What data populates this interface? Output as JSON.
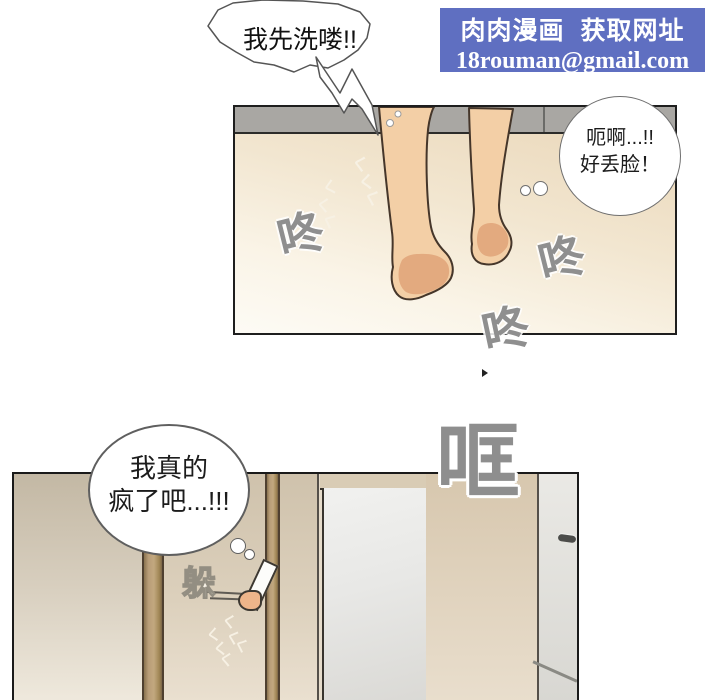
{
  "banner": {
    "title": "肉肉漫画  获取网址",
    "email": "18rouman@gmail.com",
    "bg_color": "#5f6fc1"
  },
  "panel1": {
    "speech": "我先洗喽!!",
    "thought_line1": "呃啊...!!",
    "thought_line2": "好丢脸！"
  },
  "panel2": {
    "thought_line1": "我真的",
    "thought_line2": "疯了吧...!!!",
    "sfx_clang": "哐",
    "sfx_hide": "躲"
  },
  "sfx": {
    "thud": "咚",
    "steam": "く"
  },
  "colors": {
    "skin": "#f3cfa6",
    "sfx_gray": "#8f8f8f",
    "wood_post": "#b2966e",
    "floor_top": "#e9d5b6"
  }
}
